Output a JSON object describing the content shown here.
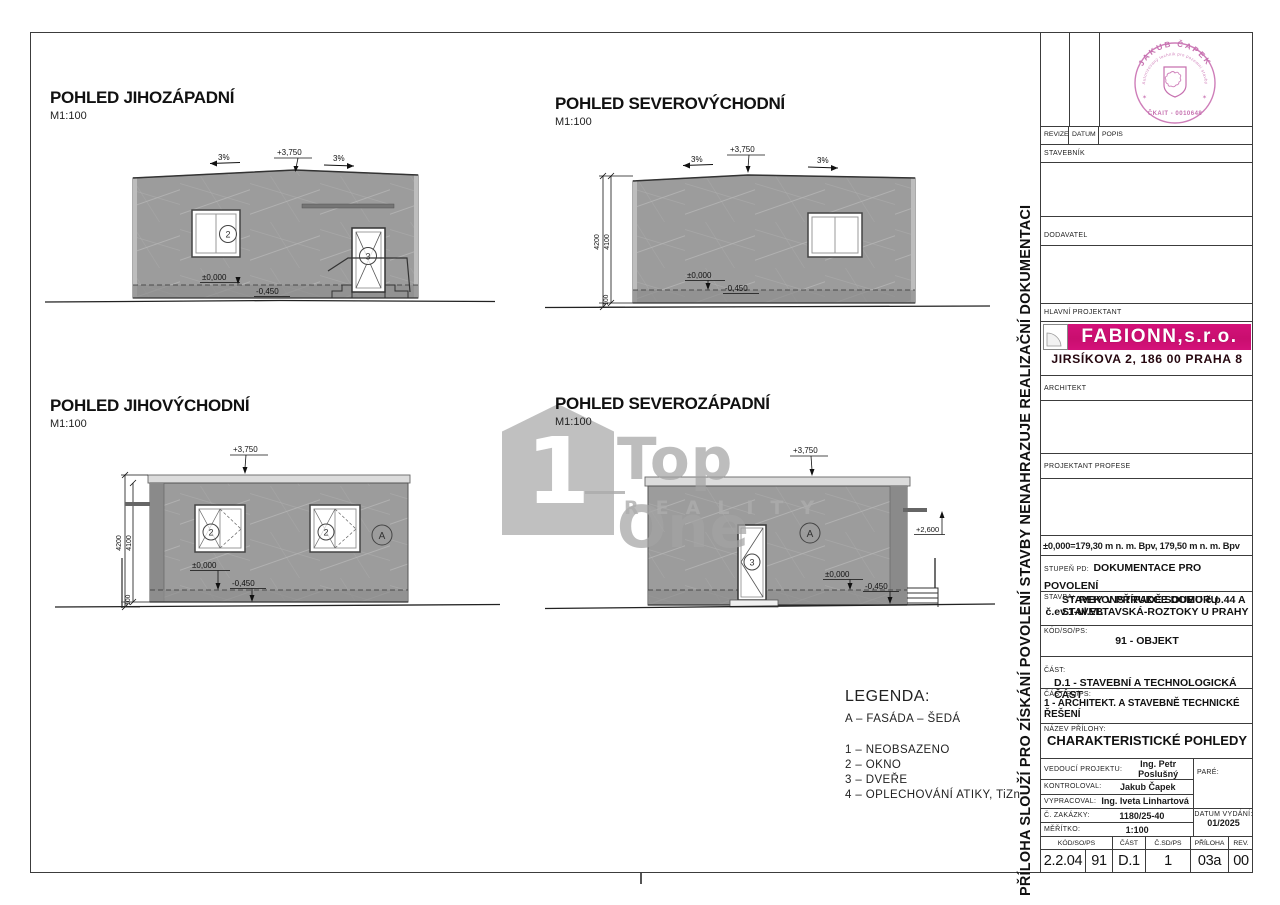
{
  "sheet": {
    "views": [
      {
        "title": "POHLED JIHOZÁPADNÍ",
        "scale": "M1:100"
      },
      {
        "title": "POHLED SEVEROVÝCHODNÍ",
        "scale": "M1:100"
      },
      {
        "title": "POHLED JIHOVÝCHODNÍ",
        "scale": "M1:100"
      },
      {
        "title": "POHLED SEVEROZÁPADNÍ",
        "scale": "M1:100"
      }
    ],
    "annotations": {
      "peak_level": "+3,750",
      "slope_left": "3%",
      "slope_right": "3%",
      "level_zero": "±0,000",
      "level_base": "-0,450",
      "ledge_level": "+2,600",
      "dim_total": "4200",
      "dim_wall": "4100",
      "dim_plinth": "100",
      "tag_window": "2",
      "tag_door": "3",
      "tag_facade": "A"
    },
    "legend": {
      "title": "LEGENDA:",
      "facade_item": "A  –  FASÁDA  –  ŠEDÁ",
      "items": [
        "1  –  NEOBSAZENO",
        "2  –  OKNO",
        "3  –  DVEŘE",
        "4  –  OPLECHOVÁNÍ ATIKY, TiZn"
      ]
    },
    "watermark": {
      "number": "1",
      "brand": "Top One",
      "subbrand": "REALITY"
    },
    "side_note": "PŘÍLOHA SLOUŽÍ PRO ZÍSKÁNÍ POVOLENÍ  STAVBY NENAHRAZUJE REALIZAČNÍ DOKUMENTACI",
    "stamp": {
      "name": "JAKUB ČAPEK",
      "middle": "Autorizovaný technik pro pozemní stavby",
      "number": "ČKAIT - 0010648"
    },
    "titleblock": {
      "rev_headers": {
        "revize": "REVIZE",
        "datum": "DATUM",
        "popis": "POPIS"
      },
      "stavebnik_label": "STAVEBNÍK",
      "dodavatel_label": "DODAVATEL",
      "hlavni_projektant_label": "HLAVNÍ PROJEKTANT",
      "logo": {
        "name": "FABIONN,s.r.o.",
        "address": "JIRSÍKOVA 2, 186 00 PRAHA 8"
      },
      "architekt_label": "ARCHITEKT",
      "projektant_profese_label": "PROJEKTANT PROFESE",
      "elevation_note": "±0,000=179,30 m n. m. Bpv, 179,50 m n. m. Bpv",
      "stupen_pd": {
        "label": "STUPEŇ PD:",
        "line1": "DOKUMENTACE PRO POVOLENÍ",
        "line2": "STAVBY V PŘÍPADĚ SOUBORU STAVEB"
      },
      "stavba": {
        "label": "STAVBA:",
        "line1": "REKONSTRUKCE DOMU č.p.44 A",
        "line2": "č.ev.1-ul.VLTAVSKÁ-ROZTOKY U PRAHY"
      },
      "kod_so_ps": {
        "label": "KÓD/SO/PS:",
        "value": "91 - OBJEKT"
      },
      "cast": {
        "label": "ČÁST:",
        "value": "D.1 - STAVEBNÍ A TECHNOLOGICKÁ ČÁST"
      },
      "cast_so_ps": {
        "label": "ČÁST SO/PS:",
        "value": "1 - ARCHITEKT. A STAVEBNĚ TECHNICKÉ ŘEŠENÍ"
      },
      "nazev_prilohy": {
        "label": "NÁZEV PŘÍLOHY:",
        "value": "CHARAKTERISTICKÉ POHLEDY"
      },
      "people": [
        {
          "label": "VEDOUCÍ PROJEKTU:",
          "value": "Ing. Petr Poslušný"
        },
        {
          "label": "KONTROLOVAL:",
          "value": "Jakub Čapek"
        },
        {
          "label": "VYPRACOVAL:",
          "value": "Ing. Iveta Linhartová"
        }
      ],
      "pare_label": "PARÉ:",
      "zakazka": {
        "label": "Č. ZAKÁZKY:",
        "value": "1180/25-40"
      },
      "meritko": {
        "label": "MĚŘÍTKO:",
        "value": "1:100"
      },
      "datum_vydani": {
        "label": "DATUM VYDÁNÍ:",
        "value": "01/2025"
      },
      "bottom_table": {
        "h_kod": "KÓD/SO/PS",
        "h_cast": "ČÁST",
        "h_csd": "Č.SD/PS",
        "h_priloha": "PŘÍLOHA",
        "h_rev": "REV.",
        "v1": "2.2.04",
        "v2": "91",
        "v3": "D.1",
        "v4": "1",
        "v5": "03a",
        "v6": "00"
      }
    }
  }
}
